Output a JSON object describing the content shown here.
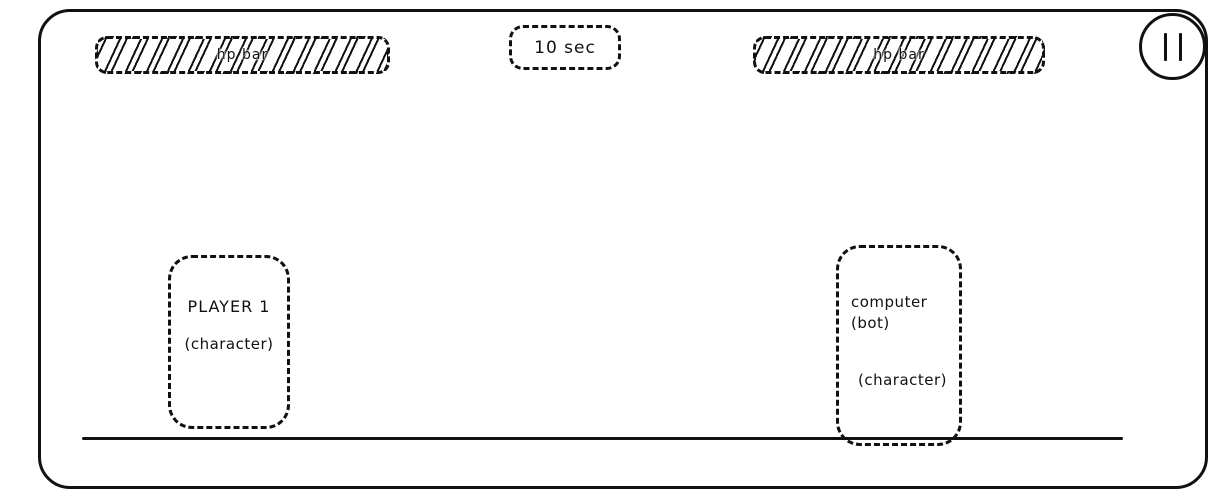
{
  "colors": {
    "ink": "#111111",
    "background": "#ffffff"
  },
  "hud": {
    "player_hp_bar": {
      "label": "hp bar"
    },
    "timer": {
      "label": "10 sec"
    },
    "opponent_hp_bar": {
      "label": "hp bar"
    },
    "pause_button": {
      "icon": "pause-icon"
    }
  },
  "stage": {
    "player_box": {
      "name": "PLAYER 1",
      "role": "(character)"
    },
    "opponent_box": {
      "name_line1": "computer",
      "name_line2": "(bot)",
      "role": "(character)"
    }
  }
}
